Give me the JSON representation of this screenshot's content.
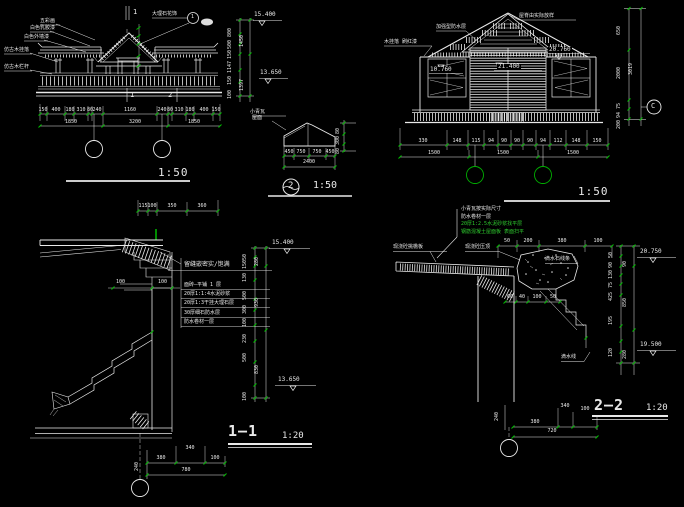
{
  "colors": {
    "background": "#000000",
    "line": "#e9e9e9",
    "dim_tick": "#00c000",
    "green_text": "#2ecc2e"
  },
  "elev_left": {
    "labels": [
      "五彩画",
      "白色乳胶漆",
      "白色外墙漆",
      "仿古木挂落",
      "仿古木栏杆"
    ],
    "callout": {
      "text": "大理石花饰",
      "num": "1"
    },
    "marks": {
      "top": "1",
      "bottom_left": "1",
      "bottom_right": "2"
    },
    "levels": {
      "top": "15.400",
      "mid": "13.650"
    },
    "right_dims_inner": [
      "800",
      "500",
      "150",
      "1147",
      "150",
      "100"
    ],
    "right_dims_outer": [
      "1450",
      "1397"
    ],
    "dims_row1": [
      "150",
      "400",
      "180",
      "310",
      "80",
      "240",
      "1160",
      "240",
      "80",
      "310",
      "180",
      "400",
      "150"
    ],
    "dims_row2": [
      "1850",
      "3200",
      "1850"
    ],
    "scale": "1:50"
  },
  "roof_detail": {
    "label_line1": "小青瓦",
    "label_line2": "屋面",
    "dims_bottom": [
      "450",
      "750",
      "750",
      "450"
    ],
    "dim_total": "2400",
    "dims_right": [
      "80",
      "300",
      "80"
    ],
    "num": "2",
    "scale": "1:50"
  },
  "elev_right": {
    "label_left": "木挂落 刷红漆",
    "label_roof": "加强型防水层",
    "label_ridge": "屋脊由实际放样",
    "levels": {
      "center": "21.400",
      "left": "10.760",
      "right": "20.760"
    },
    "dims_row1": [
      "330",
      "148",
      "115",
      "94",
      "90",
      "90",
      "90",
      "94",
      "112",
      "148",
      "150"
    ],
    "dims_row2": [
      "1500",
      "1500",
      "1500"
    ],
    "scale": "1:50",
    "side": {
      "dims": [
        "650",
        "2000",
        "75",
        "94",
        "200"
      ],
      "total": "3019",
      "axis": "C"
    }
  },
  "section1": {
    "top_dims": [
      "115",
      "100",
      "350",
      "360"
    ],
    "wall_dims": [
      "100",
      "100"
    ],
    "notes": [
      "留缝嵌密实/饱满",
      "面砖—平铺 1 层",
      "20厚1:1:4水泥砂浆",
      "20厚1:3干挂大理石层",
      "30厚细石防水层",
      "防水卷材一层"
    ],
    "levels": {
      "top": "15.400",
      "bottom": "13.650"
    },
    "right_dims_inner": [
      "50",
      "150",
      "130",
      "500",
      "300",
      "100",
      "230",
      "500",
      "100"
    ],
    "right_dims_outer": [
      "280",
      "930",
      "830"
    ],
    "bottom": {
      "v": "240",
      "dims": [
        "380",
        "340",
        "100"
      ],
      "total": "780"
    },
    "title": "1—1",
    "scale": "1:20"
  },
  "section2": {
    "notes": [
      "小青瓦按实际尺寸",
      "防水卷材一层",
      "20厚1:2.5水泥砂浆找平层",
      "钢筋混凝土屋面板 表面扫平"
    ],
    "label_slab": "现浇砼挑檐板",
    "label_coping": "现浇砼压顶",
    "label_right": "滴水石线条",
    "label_drip": "滴水线",
    "top_dims": [
      "50",
      "200",
      "380",
      "100"
    ],
    "step_dims": [
      "60",
      "40",
      "100",
      "50"
    ],
    "levels": {
      "top": "20.750",
      "bottom": "19.500"
    },
    "right_dims_inner": [
      "50",
      "90",
      "130",
      "75",
      "425",
      "195",
      "120"
    ],
    "right_dims_outer": [
      "90",
      "850",
      "280"
    ],
    "bottom": {
      "v": "240",
      "dims": [
        "380",
        "340",
        "100"
      ],
      "total": "720"
    },
    "title": "2—2",
    "scale": "1:20"
  }
}
